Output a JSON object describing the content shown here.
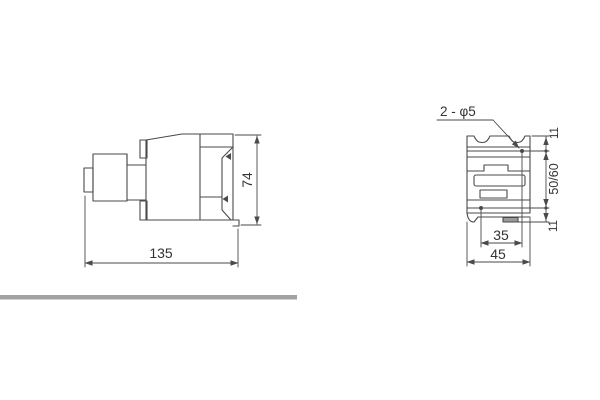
{
  "drawing": {
    "title": "contactor-outline-dimension-drawing",
    "side_view": {
      "width_label": "135",
      "height_label": "74"
    },
    "front_view": {
      "holes_callout": "2 - φ5",
      "top_offset_label": "11",
      "hole_spacing_label": "50/60",
      "bottom_offset_label": "11",
      "hole_span_label": "35",
      "width_label": "45"
    },
    "colors": {
      "line": "#4a4a4a",
      "text": "#333333",
      "divider_bar": "#a2a2a2",
      "background": "#ffffff"
    }
  }
}
